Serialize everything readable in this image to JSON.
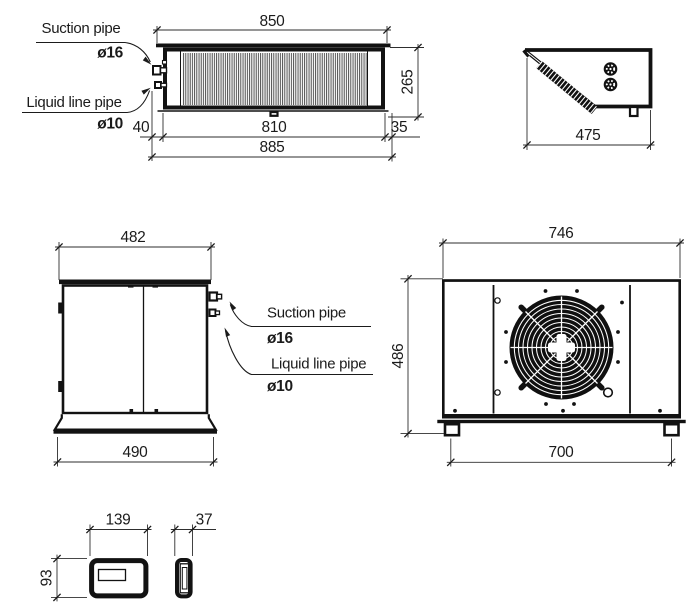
{
  "labels": {
    "suction_pipe": "Suction pipe",
    "suction_diameter": "ø16",
    "liquid_line_pipe": "Liquid line pipe",
    "liquid_diameter": "ø10"
  },
  "views": {
    "top": {
      "dims": {
        "flange_width": "850",
        "depth": "265",
        "pipe_offset": "40",
        "body_width": "810",
        "right_offset": "35",
        "overall_width": "885"
      }
    },
    "profile": {
      "dims": {
        "depth": "475"
      }
    },
    "side": {
      "dims": {
        "top_width": "482",
        "base_width": "490"
      }
    },
    "front": {
      "dims": {
        "top_width": "746",
        "height": "486",
        "feet_span": "700"
      }
    },
    "controller_front": {
      "dims": {
        "width": "139",
        "height": "93"
      }
    },
    "controller_side": {
      "dims": {
        "width": "37"
      }
    }
  },
  "colors": {
    "line": "#161616",
    "background": "#ffffff"
  }
}
